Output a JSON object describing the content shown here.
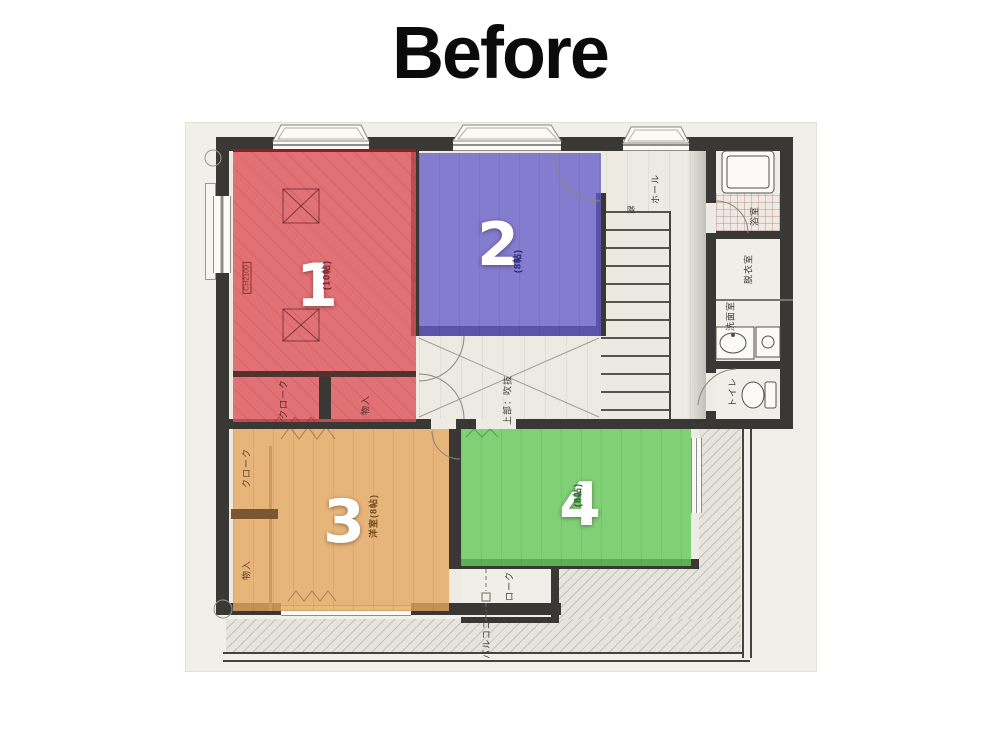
{
  "title": "Before",
  "floor_plan": {
    "rooms": [
      {
        "number": "1",
        "size_label": "(10帖)",
        "overlay_color": "rgba(221,82,89,0.80)",
        "label_color": "#6e2228"
      },
      {
        "number": "2",
        "size_label": "(8帖)",
        "overlay_color": "rgba(101,92,201,0.78)",
        "label_color": "#26266e"
      },
      {
        "number": "3",
        "size_label": "洋室(8帖)",
        "overlay_color": "rgba(229,167,94,0.80)",
        "label_color": "#6e4a1e"
      },
      {
        "number": "4",
        "size_label": "(8帖)",
        "overlay_color": "rgba(104,201,94,0.82)",
        "label_color": "#1e5e22"
      }
    ],
    "labels": {
      "hall": "ホール",
      "stairs": "階",
      "bath": "浴室",
      "dressing_room": "脱衣室",
      "washroom": "洗面室",
      "toilet": "トイレ",
      "void_above": "上部：吹抜",
      "closet_red": "クローク",
      "storage_red": "物入",
      "closet_left": "クローク",
      "storage_left": "物入",
      "closet_bottom": "クローク",
      "balcony": "バルコニー",
      "ceiling_height": "CH2100"
    },
    "colors": {
      "wall": "#3a3835",
      "paper": "#f1efe9",
      "floor": "#edebe4",
      "balcony_floor": "#e6e4dd",
      "number_text": "#ffffff"
    }
  }
}
